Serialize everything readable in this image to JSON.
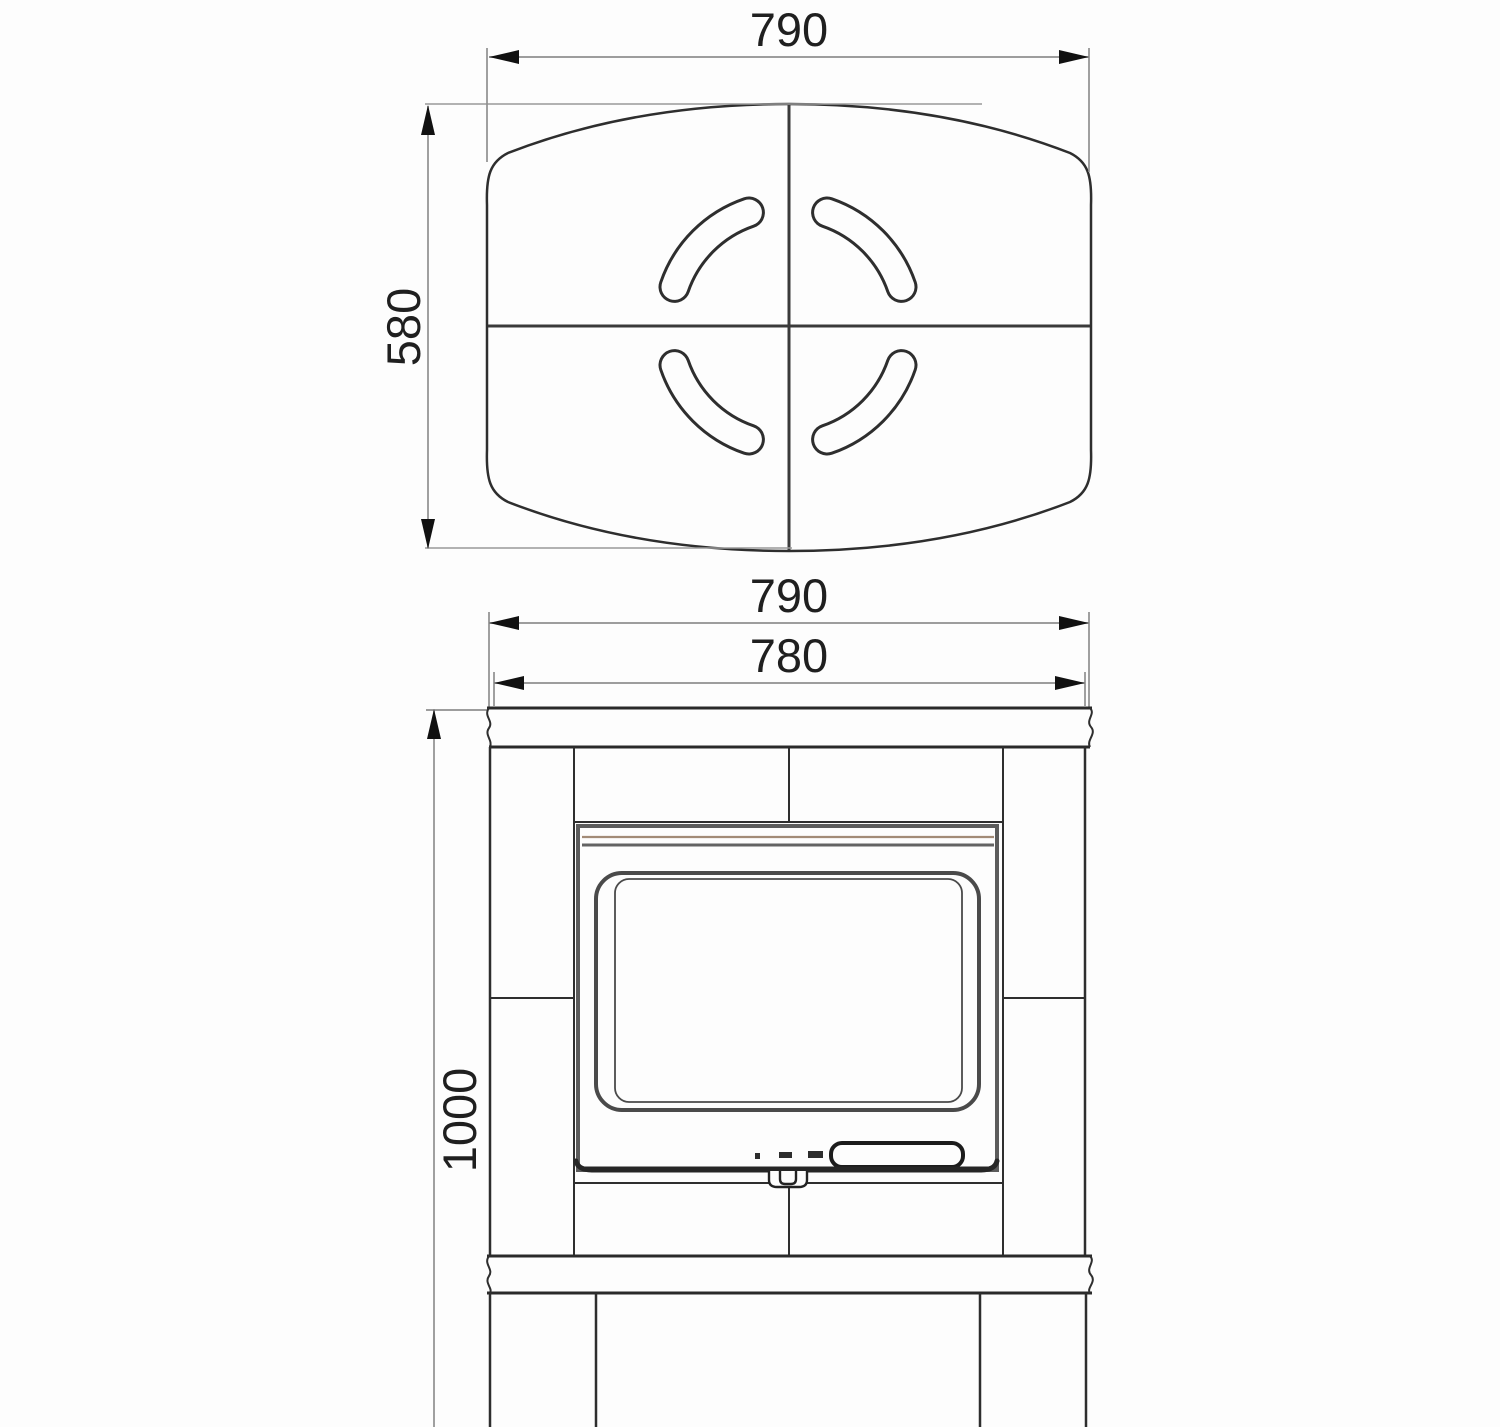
{
  "page": {
    "background": "#fdfdfd"
  },
  "drawing": {
    "type": "technical-drawing",
    "subject": "stove dimensional diagram, top view and front view",
    "views": {
      "top": {
        "label": "top-view",
        "dims": {
          "width": {
            "value": "790",
            "orientation": "horizontal"
          },
          "depth": {
            "value": "580",
            "orientation": "vertical"
          }
        }
      },
      "front": {
        "label": "front-view",
        "dims": {
          "top_width": {
            "value": "790",
            "orientation": "horizontal"
          },
          "body_width": {
            "value": "780",
            "orientation": "horizontal"
          },
          "height": {
            "value": "1000",
            "orientation": "vertical"
          }
        }
      }
    },
    "colors": {
      "outline": "#2e2e2e",
      "dimension_line": "#8f8f8f",
      "arrow": "#111111",
      "text": "#1f1f1f",
      "door_frame": "#5c5c5c",
      "glass_frame": "#4a4a4a",
      "trim_accent": "#a28b77",
      "background": "#fdfdfd"
    }
  }
}
